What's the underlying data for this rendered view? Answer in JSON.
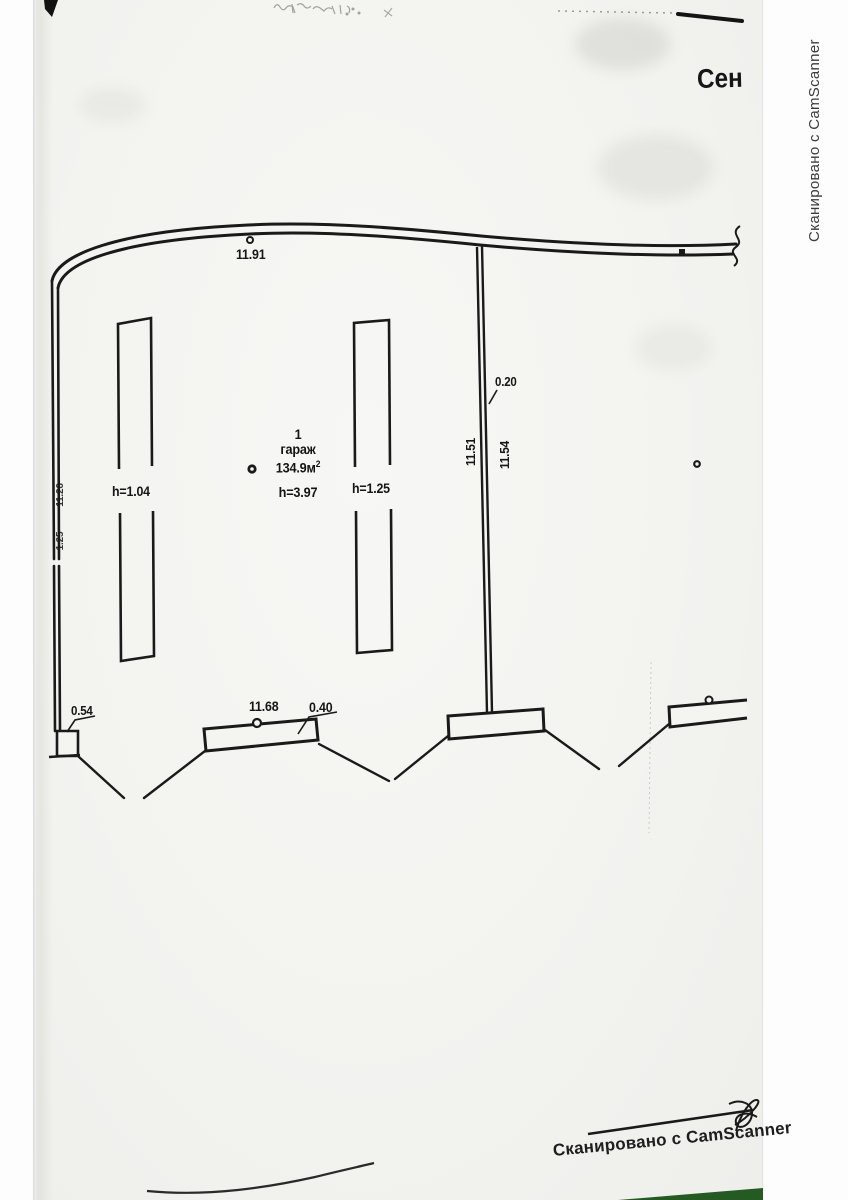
{
  "page": {
    "header_partial": "Сен",
    "watermark_side": "Сканировано с CamScanner",
    "watermark_bottom": "Сканировано с CamScanner"
  },
  "plan": {
    "top_length": "11.91",
    "left_wall_length": "11.26",
    "left_wall_offset": "1.25",
    "room_number": "1",
    "room_name": "гараж",
    "room_area": "134.9м",
    "room_area_exp": "2",
    "room_height": "h=3.97",
    "left_stall_height": "h=1.04",
    "mid_stall_height": "h=1.25",
    "fence_thickness": "0.20",
    "fence_length_left": "11.51",
    "fence_length_right": "11.54",
    "corner_box_size": "0.54",
    "bottom_bar_length": "11.68",
    "bottom_bar_width": "0.40"
  },
  "colors": {
    "ink": "#1a1a1a",
    "paper": "#f4f4f1",
    "camscanner_green": "#265a23"
  }
}
